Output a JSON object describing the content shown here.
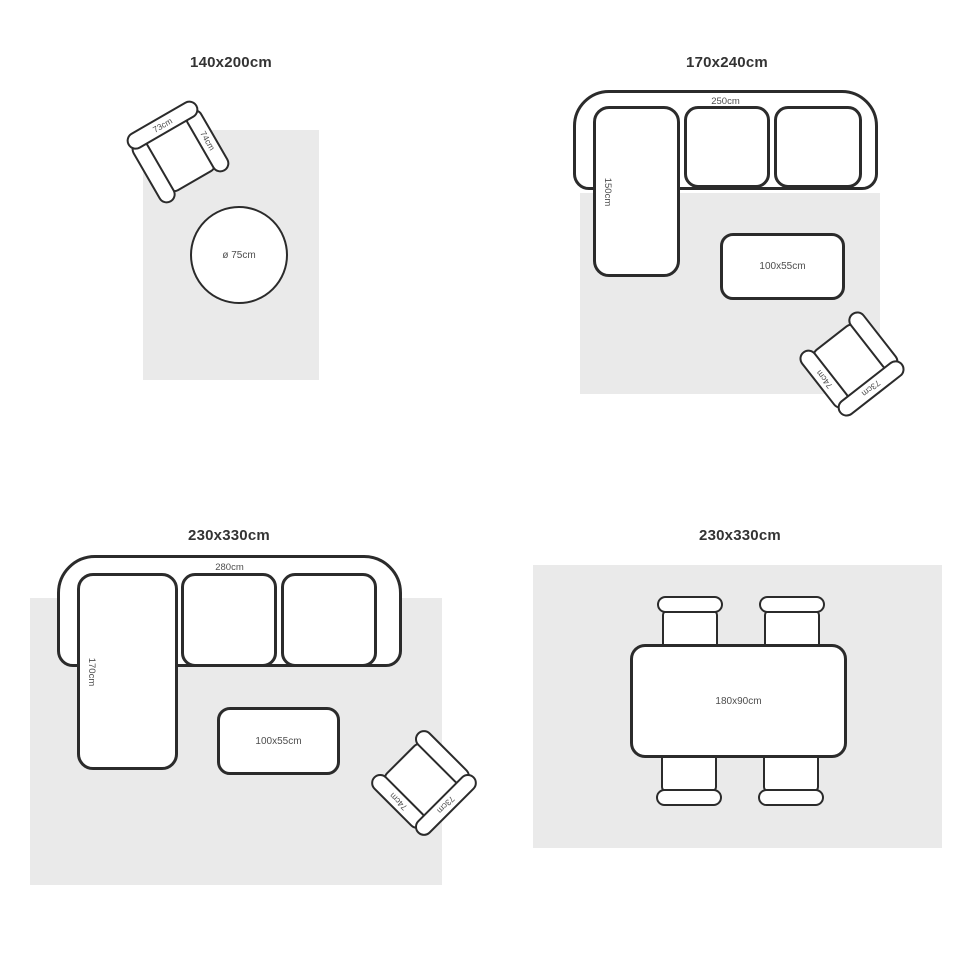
{
  "page": {
    "description": "Rug size guide with four top-view room layout diagrams",
    "background": "#ffffff"
  },
  "colors": {
    "rug_fill": "#eaeaea",
    "furniture_outline": "#2b2b2b",
    "furniture_fill": "#ffffff",
    "label_text": "#4d4d4d",
    "title_text": "#333333"
  },
  "diagrams": [
    {
      "id": "rug-140x200",
      "title": "140x200cm",
      "armchair": {
        "back_label": "73cm",
        "arm_label": "74cm"
      },
      "round_table": {
        "label": "ø 75cm"
      }
    },
    {
      "id": "rug-170x240",
      "title": "170x240cm",
      "sofa": {
        "width_label": "250cm",
        "chaise_label": "150cm"
      },
      "coffee_table": {
        "label": "100x55cm"
      },
      "armchair": {
        "back_label": "73cm",
        "arm_label": "74cm"
      }
    },
    {
      "id": "rug-230x330-living",
      "title": "230x330cm",
      "sofa": {
        "width_label": "280cm",
        "chaise_label": "170cm"
      },
      "coffee_table": {
        "label": "100x55cm"
      },
      "armchair": {
        "back_label": "73cm",
        "arm_label": "74cm"
      }
    },
    {
      "id": "rug-230x330-dining",
      "title": "230x330cm",
      "dining_table": {
        "label": "180x90cm"
      }
    }
  ]
}
